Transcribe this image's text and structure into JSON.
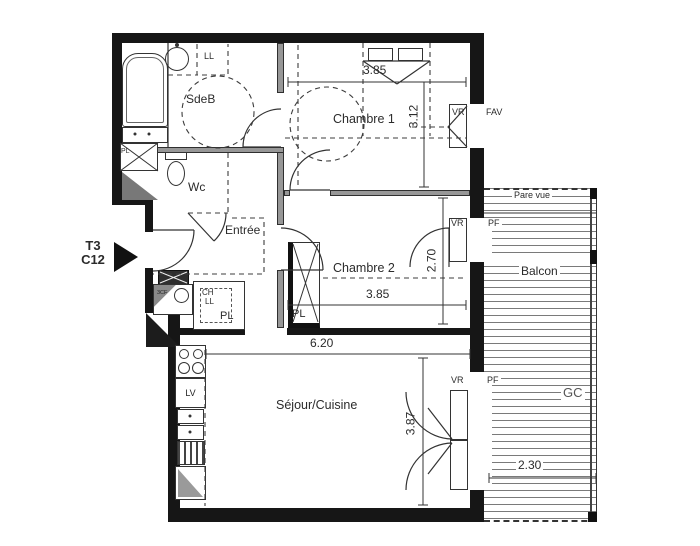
{
  "unit": {
    "type": "T3",
    "number": "C12"
  },
  "rooms": {
    "sdeb": "SdeB",
    "wc": "Wc",
    "entree": "Entrée",
    "chambre1": "Chambre 1",
    "chambre2": "Chambre 2",
    "sejour": "Séjour/Cuisine",
    "balcon": "Balcon"
  },
  "dimensions": {
    "chambre1_width": "3.85",
    "chambre1_depth": "3.12",
    "chambre2_width": "3.85",
    "chambre2_depth": "2.70",
    "sejour_width": "6.20",
    "sejour_depth": "3.87",
    "balcon_width": "2.30"
  },
  "fixtures": {
    "washer": "LL",
    "boiler": "CH",
    "washer_closet": "LL",
    "dishwasher": "LV",
    "closet_bath": "PL",
    "closet_hall": "PL",
    "closet_chambre2": "PL",
    "meter_box": "3CF"
  },
  "openings": {
    "chambre1_shutter": "VR",
    "chambre1_window": "FAV",
    "chambre2_shutter": "VR",
    "chambre2_door": "PF",
    "sejour_shutter": "VR",
    "sejour_door": "PF"
  },
  "balcony": {
    "screen": "Pare vue",
    "railing": "GC"
  }
}
